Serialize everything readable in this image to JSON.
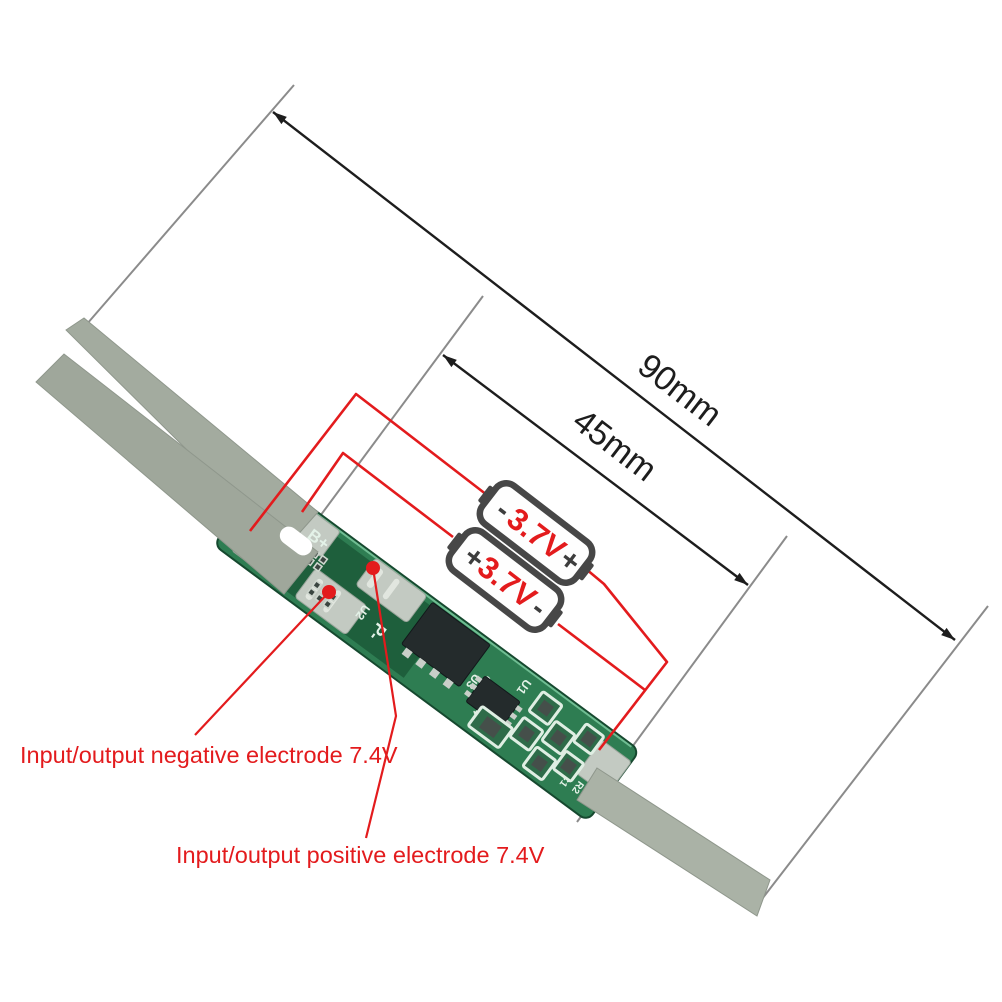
{
  "dimensions": {
    "outer": "90mm",
    "board": "45mm"
  },
  "batteries": {
    "cell1": {
      "left": "-",
      "label": "3.7V",
      "right": "+"
    },
    "cell2": {
      "left": "+",
      "label": "3.7V",
      "right": "-"
    }
  },
  "callouts": {
    "negative": "Input/output negative electrode 7.4V",
    "positive": "Input/output positive electrode 7.4V"
  },
  "pcb_silkscreen": {
    "b_plus": "B+",
    "b_minus": "B-",
    "p_plus": "P+",
    "p_minus": "P-",
    "u1": "U1",
    "u2": "U2",
    "u3": "U3",
    "r4": "R4",
    "c1": "C1",
    "r2": "R2",
    "c2": "C2"
  },
  "colors": {
    "red": "#e31b1d",
    "dim_line": "#1d1d1d",
    "extension_line": "#8b8b8b",
    "board_green": "#2e7d52",
    "board_dark": "#1e5f3c",
    "board_edge": "#16492f",
    "pad_silver": "#c3cac2",
    "strip": "#a3ab9f",
    "strip_light": "#b5bcb1",
    "battery_outline": "#474747",
    "ic_dark": "#242b2c",
    "silk": "#e4f2e8"
  }
}
